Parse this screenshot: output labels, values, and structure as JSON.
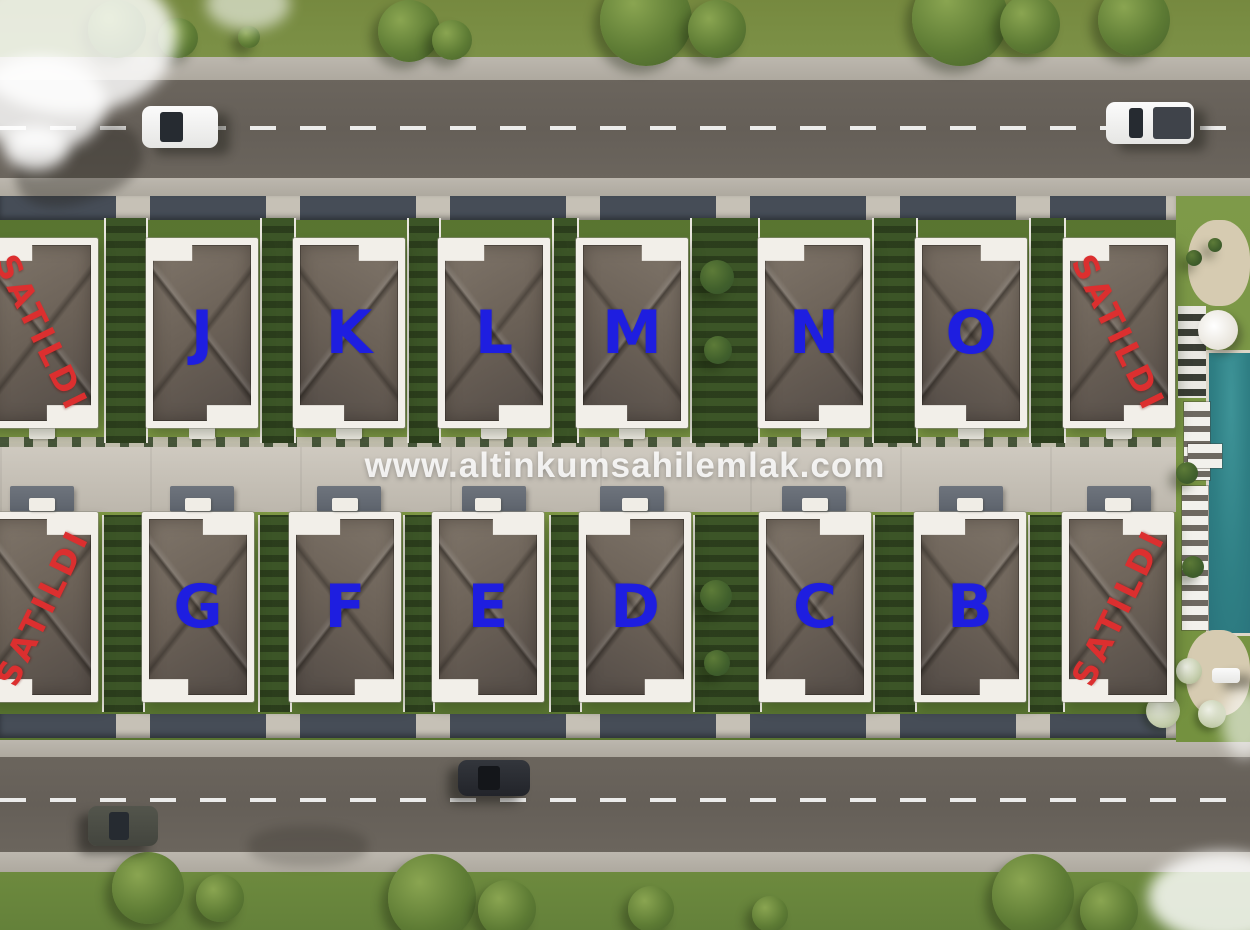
{
  "watermark": "www.altinkumsahilemlak.com",
  "site": {
    "rows": [
      {
        "name": "north-row",
        "units": [
          {
            "label": "SATILDI",
            "sold": true
          },
          {
            "label": "J",
            "sold": false
          },
          {
            "label": "K",
            "sold": false
          },
          {
            "label": "L",
            "sold": false
          },
          {
            "label": "M",
            "sold": false
          },
          {
            "label": "N",
            "sold": false
          },
          {
            "label": "O",
            "sold": false
          },
          {
            "label": "SATILDI",
            "sold": true
          }
        ]
      },
      {
        "name": "south-row",
        "units": [
          {
            "label": "SATILDI",
            "sold": true
          },
          {
            "label": "G",
            "sold": false
          },
          {
            "label": "F",
            "sold": false
          },
          {
            "label": "E",
            "sold": false
          },
          {
            "label": "D",
            "sold": false
          },
          {
            "label": "C",
            "sold": false
          },
          {
            "label": "B",
            "sold": false
          },
          {
            "label": "SATILDI",
            "sold": true
          }
        ]
      }
    ]
  },
  "scene": {
    "vehicles": [
      "white-sedan",
      "white-pickup-truck",
      "dark-suv",
      "dark-sedan"
    ],
    "amenities": [
      "swimming-pool",
      "sun-loungers",
      "umbrella",
      "garden-paths"
    ]
  },
  "colors": {
    "unit_letter": "#1e1ee0",
    "sold_text": "#dc2f2f",
    "roof": "#6b6157",
    "grass": "#5e7b34",
    "road": "#655f58",
    "sidewalk": "#b6b1a8",
    "pavement": "#c8c2b7",
    "pool": "#2f7f84",
    "watermark_text": "#ffffff"
  }
}
